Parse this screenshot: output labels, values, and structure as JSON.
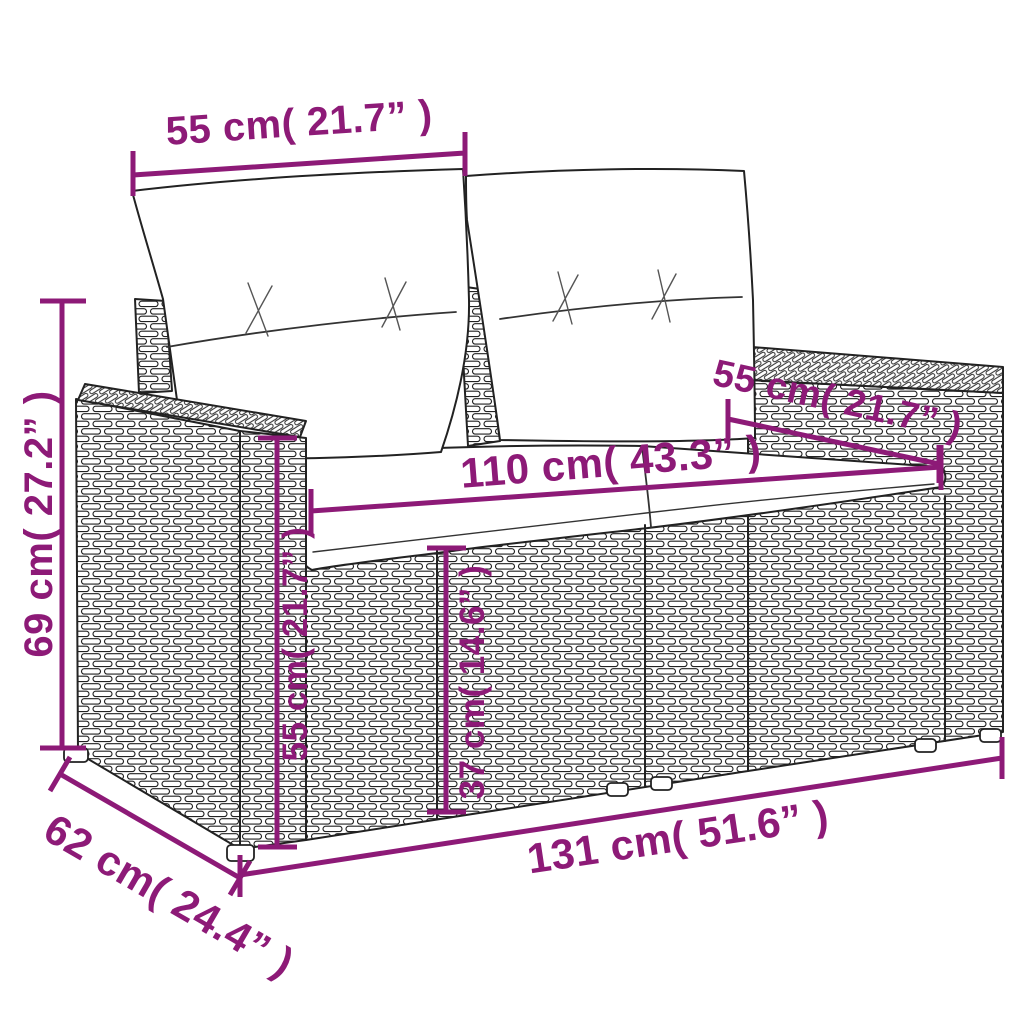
{
  "meta": {
    "title": "Garden sofa dimension diagram",
    "product": "poly rattan 2-seater garden sofa with cushions",
    "accent_color": "#8D1A77",
    "line_color": "#222222",
    "background_color": "#ffffff"
  },
  "dims": {
    "back_width": {
      "label": "55 cm( 21.7” )",
      "value_cm": 55,
      "value_in": 21.7
    },
    "height": {
      "label": "69 cm( 27.2” )",
      "value_cm": 69,
      "value_in": 27.2
    },
    "seat_width": {
      "label": "110 cm( 43.3” )",
      "value_cm": 110,
      "value_in": 43.3
    },
    "armrest_depth": {
      "label": "55 cm( 21.7” )",
      "value_cm": 55,
      "value_in": 21.7
    },
    "armrest_height": {
      "label": "55 cm( 21.7” )",
      "value_cm": 55,
      "value_in": 21.7
    },
    "seat_height": {
      "label": "37 cm( 14.6” )",
      "value_cm": 37,
      "value_in": 14.6
    },
    "total_width": {
      "label": "131 cm( 51.6” )",
      "value_cm": 131,
      "value_in": 51.6
    },
    "depth": {
      "label": "62 cm( 24.4” )",
      "value_cm": 62,
      "value_in": 24.4
    }
  }
}
